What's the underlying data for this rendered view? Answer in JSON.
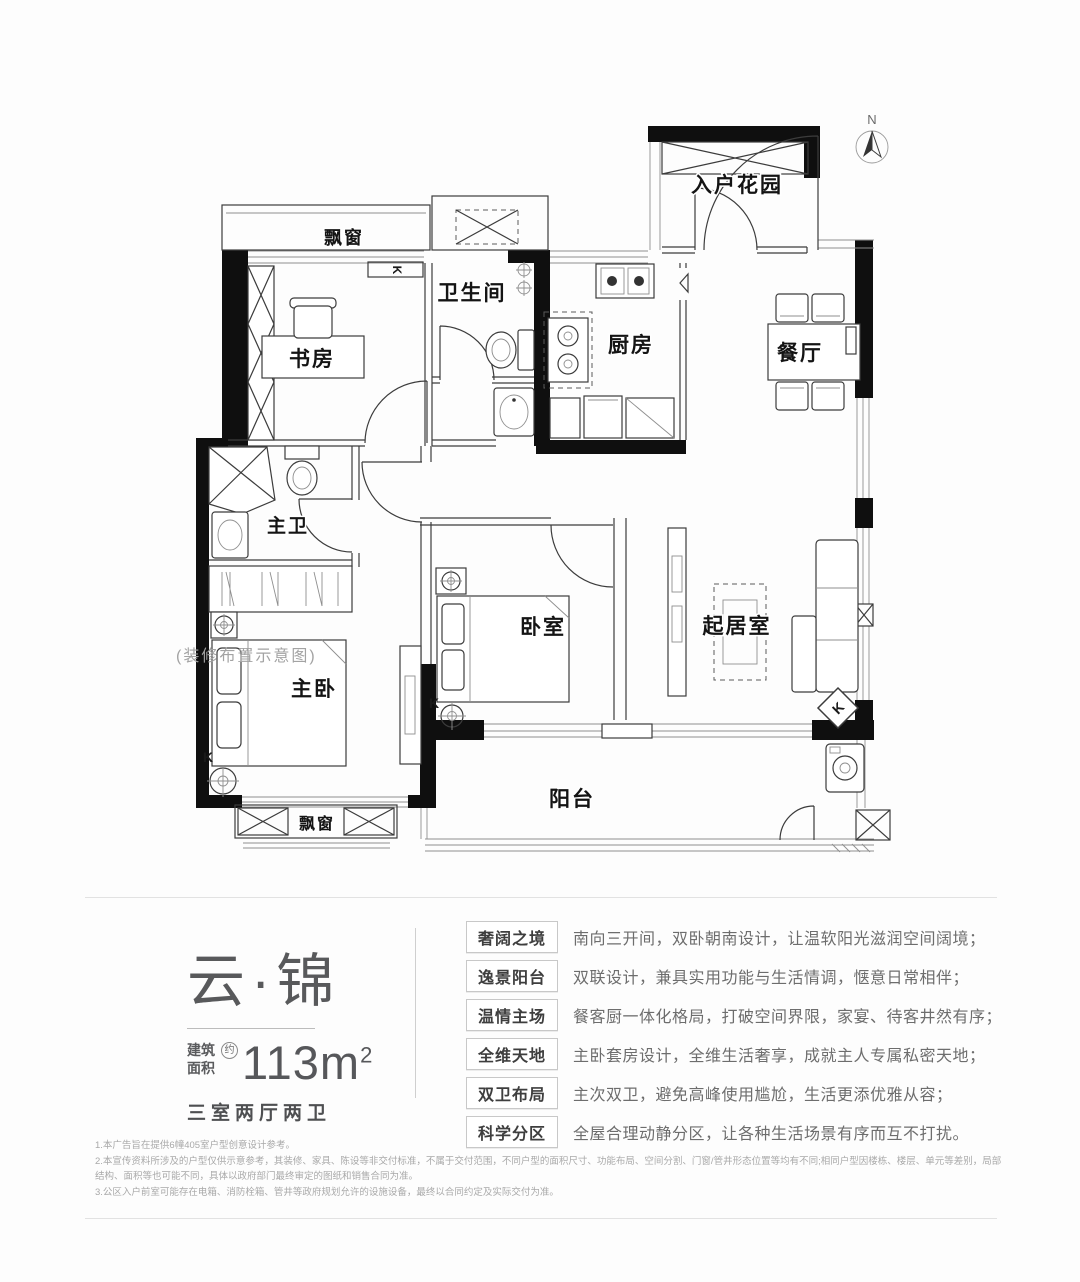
{
  "plan": {
    "rooms": {
      "bay_window_top": "飘窗",
      "study": "书房",
      "bathroom": "卫生间",
      "kitchen": "厨房",
      "dining": "餐厅",
      "entry_garden": "入户花园",
      "master_bath": "主卫",
      "master_bedroom": "主卧",
      "bedroom": "卧室",
      "living_room": "起居室",
      "balcony": "阳台",
      "bay_window_bottom": "飘窗"
    },
    "compass_north": "N",
    "ac_marker": "K",
    "watermark": "(装修布置示意图)"
  },
  "info": {
    "title": "云·锦",
    "area_prefix_line1": "建筑",
    "area_prefix_line2": "面积",
    "area_approx": "约",
    "area_value": "113m",
    "area_superscript": "2",
    "layout_text": "三室两厅两卫"
  },
  "features": [
    {
      "label": "奢阔之境",
      "desc": "南向三开间，双卧朝南设计，让温软阳光滋润空间阔境；"
    },
    {
      "label": "逸景阳台",
      "desc": "双联设计，兼具实用功能与生活情调，惬意日常相伴；"
    },
    {
      "label": "温情主场",
      "desc": "餐客厨一体化格局，打破空间界限，家宴、待客井然有序；"
    },
    {
      "label": "全维天地",
      "desc": "主卧套房设计，全维生活奢享，成就主人专属私密天地；"
    },
    {
      "label": "双卫布局",
      "desc": "主次双卫，避免高峰使用尴尬，生活更添优雅从容；"
    },
    {
      "label": "科学分区",
      "desc": "全屋合理动静分区，让各种生活场景有序而互不打扰。"
    }
  ],
  "disclaimers": [
    "1.本广告旨在提供6幢405室户型创意设计参考。",
    "2.本宣传资料所涉及的户型仅供示意参考，其装修、家具、陈设等非交付标准，不属于交付范围，不同户型的面积尺寸、功能布局、空间分割、门窗/管井形态位置等均有不同;相同户型因楼栋、楼层、单元等差别，局部结构、面积等也可能不同，具体以政府部门最终审定的图纸和销售合同为准。",
    "3.公区入户前室可能存在电箱、消防栓箱、管井等政府规划允许的设施设备，最终以合同约定及实际交付为准。"
  ],
  "colors": {
    "wall": "#0f0f0f",
    "line": "#3c3c3c",
    "divider": "#e2e2e2",
    "text_primary": "#58595b",
    "text_secondary": "#6d6d6d",
    "fine_print": "#a9a9a9"
  }
}
